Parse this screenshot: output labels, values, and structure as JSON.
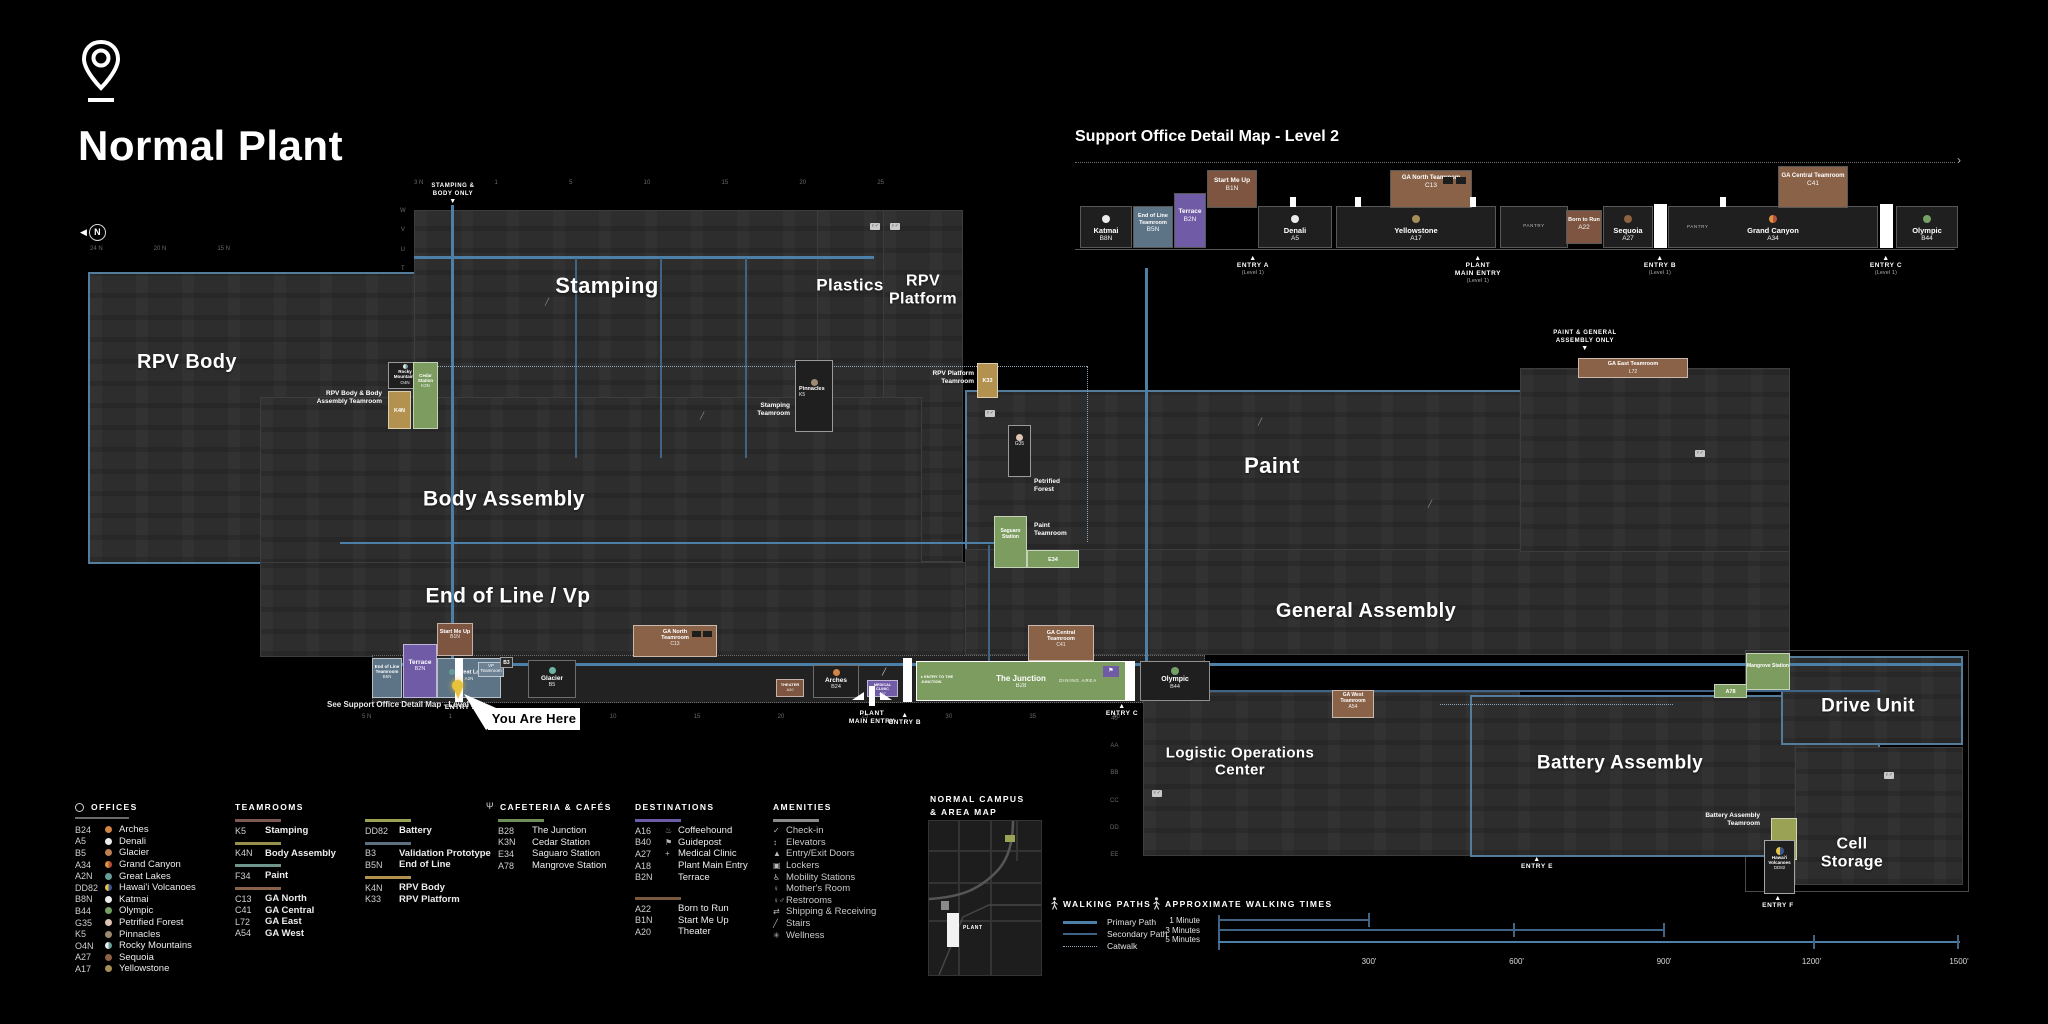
{
  "header": {
    "title": "Normal Plant"
  },
  "icons": {
    "restroom": "♀♂",
    "stairs": "╱",
    "elevator": "↕",
    "flag": "⚑",
    "coffee": "♨",
    "medical": "+",
    "check": "✓",
    "lockers": "▣",
    "mobility": "♿",
    "mother": "♀",
    "shipping": "⇄",
    "wellness": "✳",
    "doors": "▲",
    "fork": "Ψ",
    "tri_up": "▲",
    "tri_down": "▼",
    "arrow_right": "›",
    "entry_arrow": "▸",
    "compass": "N"
  },
  "detail_map": {
    "title": "Support Office Detail Map - Level 2",
    "pantry": "PANTRY",
    "rooms": {
      "katmai": {
        "name": "Katmai",
        "code": "B8N"
      },
      "end_of_line": {
        "name": "End of Line Teamroom",
        "code": "B5N"
      },
      "terrace": {
        "name": "Terrace",
        "code": "B2N"
      },
      "start_me_up": {
        "name": "Start Me Up",
        "code": "B1N"
      },
      "denali": {
        "name": "Denali",
        "code": "A5"
      },
      "yellowstone": {
        "name": "Yellowstone",
        "code": "A17"
      },
      "ga_north": {
        "name": "GA North Teamroom",
        "code": "C13"
      },
      "born_to_run": {
        "name": "Born to Run",
        "code": "A22"
      },
      "sequoia": {
        "name": "Sequoia",
        "code": "A27"
      },
      "grand_canyon": {
        "name": "Grand Canyon",
        "code": "A34"
      },
      "ga_central": {
        "name": "GA Central Teamroom",
        "code": "C41"
      },
      "olympic": {
        "name": "Olympic",
        "code": "B44"
      }
    },
    "entries": {
      "a": {
        "l1": "ENTRY A",
        "sub": "(Level 1)"
      },
      "main": {
        "l1": "PLANT",
        "l2": "MAIN ENTRY",
        "sub": "(Level 1)"
      },
      "b": {
        "l1": "ENTRY B",
        "sub": "(Level 1)"
      },
      "c": {
        "l1": "ENTRY C",
        "sub": "(Level 1)"
      }
    }
  },
  "map": {
    "areas": {
      "rpv_body": {
        "label": "RPV Body"
      },
      "stamping": {
        "label": "Stamping"
      },
      "plastics": {
        "label": "Plastics"
      },
      "rpv_platform": {
        "l1": "RPV",
        "l2": "Platform"
      },
      "body_assembly": {
        "label": "Body Assembly"
      },
      "end_of_line": {
        "label": "End of Line / Vp"
      },
      "paint": {
        "label": "Paint"
      },
      "general_assembly": {
        "label": "General Assembly"
      },
      "logistics": {
        "l1": "Logistic Operations",
        "l2": "Center"
      },
      "battery": {
        "label": "Battery Assembly"
      },
      "drive_unit": {
        "label": "Drive Unit"
      },
      "cell_storage": {
        "l1": "Cell",
        "l2": "Storage"
      }
    },
    "entries": {
      "stamping_body": {
        "l1": "STAMPING &",
        "l2": "BODY ONLY"
      },
      "paint_ga": {
        "l1": "PAINT & GENERAL",
        "l2": "ASSEMBLY ONLY"
      },
      "entry_a": "ENTRY A",
      "plant_main": {
        "l1": "PLANT",
        "l2": "MAIN ENTRY"
      },
      "entry_b": "ENTRY B",
      "entry_c": "ENTRY C",
      "entry_e": "ENTRY E",
      "entry_f": "ENTRY F"
    },
    "you_are_here": "You Are Here",
    "see_detail": "See Support Office Detail Map - Level 2",
    "callouts": {
      "body_tr_label": "RPV Body & Body Assembly Teamroom",
      "rocky": {
        "name": "Rocky Mountains",
        "code": "O4N"
      },
      "k4n": "K4N",
      "cedar": {
        "name": "Cedar Station",
        "code": "K3N"
      },
      "stamping_tr_label": "Stamping Teamroom",
      "pinnacles": {
        "name": "Pinnacles",
        "code": "K5"
      },
      "rpvp_tr_label": "RPV Platform Teamroom",
      "k33": "K33",
      "petrified": {
        "name": "Petrified Forest",
        "code": "G35"
      },
      "paint_tr_label": "Paint Teamroom",
      "saguaro": {
        "name": "Saguaro Station",
        "code": "E34"
      },
      "ga_north": {
        "name": "GA North Teamroom",
        "code": "C13"
      },
      "ga_central": {
        "name": "GA Central Teamroom",
        "code": "C41"
      },
      "ga_east": {
        "name": "GA East Teamroom",
        "code": "L72"
      },
      "ga_west": {
        "name": "GA West Teamroom",
        "code": "A54"
      },
      "junction": {
        "entry": "ENTRY TO THE JUNCTION",
        "name": "The Junction",
        "code": "B28",
        "dining": "DINING AREA"
      },
      "olympic": {
        "name": "Olympic",
        "code": "B44"
      },
      "arches": {
        "name": "Arches",
        "code": "B24"
      },
      "medical": {
        "name": "Medical Clinic",
        "code": "A27"
      },
      "theater": {
        "name": "Theater",
        "code": "A20"
      },
      "glacier": {
        "name": "Glacier",
        "code": "B5"
      },
      "great_lakes": {
        "name": "Great Lakes",
        "code": "A2N"
      },
      "vp": {
        "name": "VP Teamroom",
        "code": "B3"
      },
      "eol_tr": {
        "name": "End of Line Teamroom",
        "code": "B5N"
      },
      "terrace": {
        "name": "Terrace",
        "code": "B2N"
      },
      "start_me_up": {
        "name": "Start Me Up",
        "code": "B1N"
      },
      "mangrove": {
        "name": "Mangrove Station",
        "code": "A78"
      },
      "battery_tr_label": "Battery Assembly Teamroom",
      "hawaii": {
        "name": "Hawai'i Volcanoes",
        "code": "DD82"
      }
    },
    "grid": {
      "top": [
        "3 N",
        "1",
        "5",
        "10",
        "15",
        "20",
        "25"
      ],
      "top_left": [
        "24 N",
        "20 N",
        "15 N"
      ],
      "bottom": [
        "5 N",
        "1",
        "5",
        "10",
        "15",
        "20",
        "25",
        "30",
        "35",
        "40"
      ],
      "left_letters": [
        "W",
        "V",
        "U",
        "T"
      ],
      "loc_letters": [
        "40",
        "AA",
        "BB",
        "CC",
        "DD",
        "EE"
      ]
    }
  },
  "legend": {
    "offices": {
      "heading": "OFFICES",
      "items": [
        {
          "code": "B24",
          "name": "Arches",
          "color": "#d28445"
        },
        {
          "code": "A5",
          "name": "Denali",
          "color": "#ececec"
        },
        {
          "code": "B5",
          "name": "Glacier",
          "color": "#bd8052"
        },
        {
          "code": "A34",
          "name": "Grand Canyon",
          "color": "linear-gradient(90deg,#db9440 50%,#b7503c 50%)"
        },
        {
          "code": "A2N",
          "name": "Great Lakes",
          "color": "#659e96"
        },
        {
          "code": "DD82",
          "name": "Hawai'i Volcanoes",
          "color": "linear-gradient(90deg,#e5c44c 50%,#3f568c 50%)"
        },
        {
          "code": "B8N",
          "name": "Katmai",
          "color": "#ececec"
        },
        {
          "code": "B44",
          "name": "Olympic",
          "color": "#74a065"
        },
        {
          "code": "G35",
          "name": "Petrified Forest",
          "color": "#dfc3b4"
        },
        {
          "code": "K5",
          "name": "Pinnacles",
          "color": "#9c8a70"
        },
        {
          "code": "O4N",
          "name": "Rocky Mountains",
          "color": "linear-gradient(90deg,#ececec 50%,#659e96 50%)"
        },
        {
          "code": "A27",
          "name": "Sequoia",
          "color": "#8e6242"
        },
        {
          "code": "A17",
          "name": "Yellowstone",
          "color": "#a68e58"
        }
      ]
    },
    "teamrooms": {
      "heading": "TEAMROOMS",
      "g1": {
        "code": "K5",
        "name": "Stamping",
        "color": "#7d5852"
      },
      "g2": {
        "code": "K4N",
        "name": "Body Assembly",
        "color": "#97914d"
      },
      "g3": {
        "code": "F34",
        "name": "Paint",
        "color": "#6f958c"
      },
      "g4": {
        "color": "#8a6248",
        "items": [
          {
            "code": "C13",
            "name": "GA North"
          },
          {
            "code": "C41",
            "name": "GA Central"
          },
          {
            "code": "L72",
            "name": "GA East"
          },
          {
            "code": "A54",
            "name": "GA West"
          }
        ]
      },
      "g5": {
        "code": "DD82",
        "name": "Battery",
        "color": "#9aa355"
      },
      "g6": {
        "color": "#5d7181",
        "items": [
          {
            "code": "B3",
            "name": "Validation Prototype"
          },
          {
            "code": "B5N",
            "name": "End of Line"
          }
        ]
      },
      "g7": {
        "color": "#b3914f",
        "items": [
          {
            "code": "K4N",
            "name": "RPV Body"
          },
          {
            "code": "K33",
            "name": "RPV Platform"
          }
        ]
      }
    },
    "cafeteria": {
      "heading": "CAFETERIA & CAFÉS",
      "items": [
        {
          "code": "B28",
          "name": "The Junction"
        },
        {
          "code": "K3N",
          "name": "Cedar Station"
        },
        {
          "code": "E34",
          "name": "Saguaro Station"
        },
        {
          "code": "A78",
          "name": "Mangrove Station"
        }
      ]
    },
    "destinations": {
      "heading": "DESTINATIONS",
      "primary": [
        {
          "code": "A16",
          "icon": "♨",
          "name": "Coffeehound"
        },
        {
          "code": "B40",
          "icon": "⚑",
          "name": "Guidepost"
        },
        {
          "code": "A27",
          "icon": "+",
          "name": "Medical Clinic"
        },
        {
          "code": "A18",
          "icon": "",
          "name": "Plant Main Entry"
        },
        {
          "code": "B2N",
          "icon": "",
          "name": "Terrace"
        }
      ],
      "secondary": [
        {
          "code": "A22",
          "name": "Born to Run"
        },
        {
          "code": "B1N",
          "name": "Start Me Up"
        },
        {
          "code": "A20",
          "name": "Theater"
        }
      ]
    },
    "amenities": {
      "heading": "AMENITIES",
      "items": [
        {
          "icon": "✓",
          "name": "Check-in"
        },
        {
          "icon": "↕",
          "name": "Elevators"
        },
        {
          "icon": "▲",
          "name": "Entry/Exit Doors"
        },
        {
          "icon": "▣",
          "name": "Lockers"
        },
        {
          "icon": "♿",
          "name": "Mobility Stations"
        },
        {
          "icon": "♀",
          "name": "Mother's Room"
        },
        {
          "icon": "♀♂",
          "name": "Restrooms"
        },
        {
          "icon": "⇄",
          "name": "Shipping & Receiving"
        },
        {
          "icon": "╱",
          "name": "Stairs"
        },
        {
          "icon": "✳",
          "name": "Wellness"
        }
      ]
    },
    "campus": {
      "l1": "NORMAL CAMPUS",
      "l2": "& AREA MAP",
      "plant": "PLANT"
    },
    "walking_paths": {
      "heading": "WALKING PATHS",
      "primary": "Primary Path",
      "secondary": "Secondary Path",
      "catwalk": "Catwalk"
    },
    "walking_times": {
      "heading": "APPROXIMATE WALKING TIMES",
      "times": [
        "1 Minute",
        "3 Minutes",
        "5 Minutes"
      ],
      "scale": [
        "300'",
        "600'",
        "900'",
        "1200'",
        "1500'"
      ]
    }
  }
}
